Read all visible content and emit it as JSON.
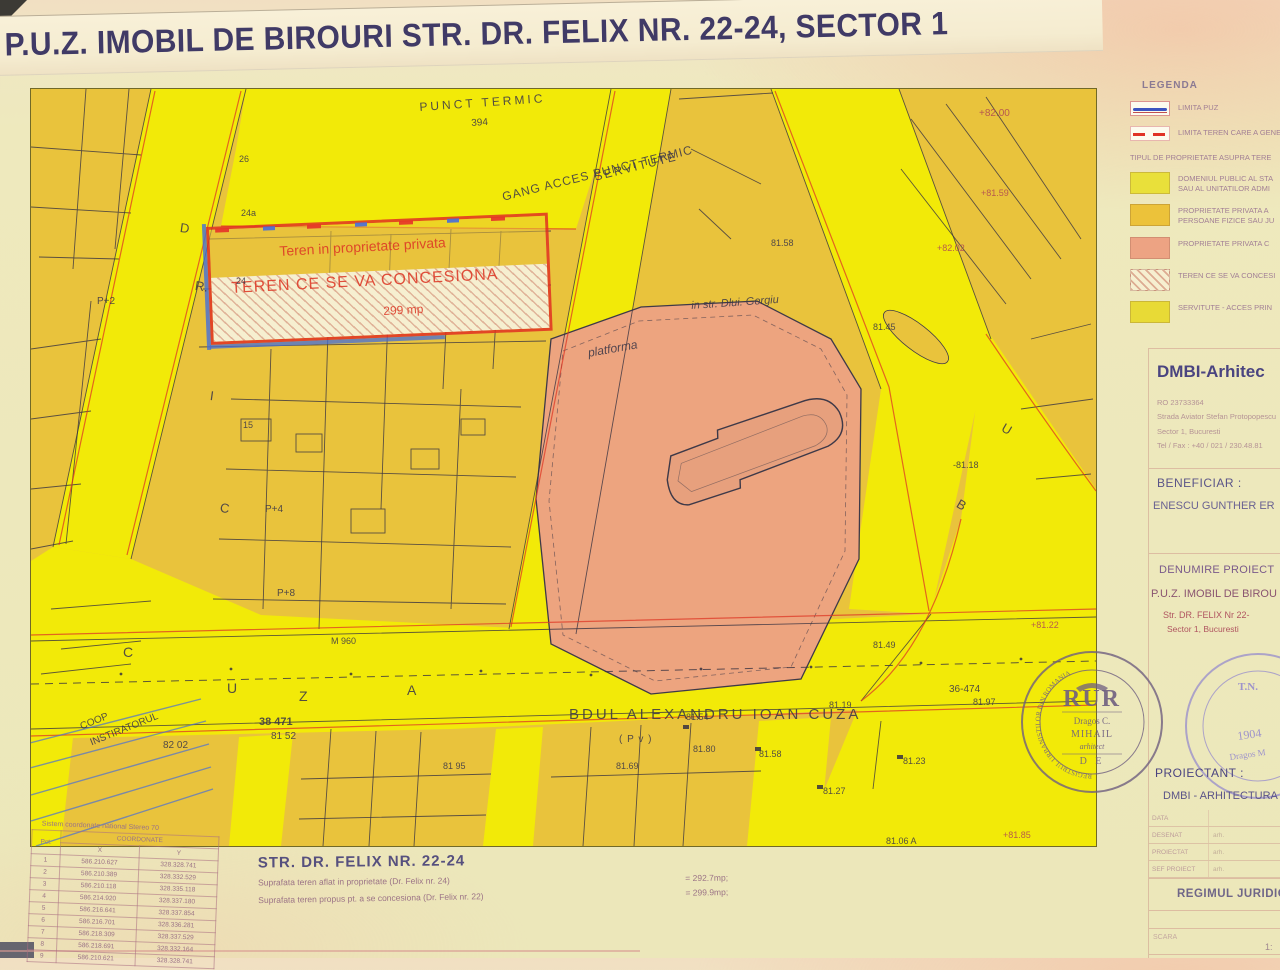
{
  "title": "P.U.Z. IMOBIL DE BIROURI STR. DR. FELIX NR. 22-24, SECTOR 1",
  "colors": {
    "road_yellow": "#f2ea08",
    "parcel_mustard": "#e9c33c",
    "private_salmon": "#eda47f",
    "line_red": "#dd3826",
    "line_blue": "#4a6fd4",
    "ink": "#3e3948"
  },
  "legend": {
    "heading": "LEGENDA",
    "line_items": [
      {
        "swatch": "line-blue",
        "label": "LIMITA PUZ"
      },
      {
        "swatch": "line-red",
        "label": "LIMITA TEREN CARE A GENER"
      }
    ],
    "section_heading": "TIPUL DE PROPRIETATE ASUPRA TERE",
    "items": [
      {
        "swatch": "yellow",
        "label": "DOMENIUL PUBLIC AL STA",
        "label2": "SAU AL UNITATILOR ADMI"
      },
      {
        "swatch": "orange",
        "label": "PROPRIETATE PRIVATA A",
        "label2": "PERSOANE FIZICE SAU JU"
      },
      {
        "swatch": "salmon",
        "label": "PROPRIETATE PRIVATA C",
        "label2": ""
      },
      {
        "swatch": "hatch",
        "label": "TEREN CE SE VA CONCESI",
        "label2": ""
      },
      {
        "swatch": "serv",
        "label": "SERVITUTE - ACCES PRIN",
        "label2": ""
      }
    ]
  },
  "panel": {
    "firm": "DMBI-Arhitec",
    "reg": "RO 23733364",
    "addr1": "Strada Aviator Stefan Protopopescu",
    "addr2": "Sector 1, Bucuresti",
    "tel": "Tel / Fax : +40 / 021 / 230.48.81",
    "beneficiar_label": "BENEFICIAR :",
    "beneficiar": "ENESCU GUNTHER ER",
    "denumire_label": "DENUMIRE PROIECT",
    "denumire1": "P.U.Z. IMOBIL DE BIROU",
    "denumire2": "Str. DR. FELIX Nr 22-",
    "denumire3": "Sector 1, Bucuresti",
    "proiectant_label": "PROIECTANT :",
    "proiectant": "DMBI - ARHITECTURA",
    "rows": [
      {
        "label": "DATA",
        "value": ""
      },
      {
        "label": "DESENAT",
        "value": "arh."
      },
      {
        "label": "PROIECTAT",
        "value": "arh."
      },
      {
        "label": "SEF PROIECT",
        "value": "arh."
      }
    ],
    "regim": "REGIMUL JURIDIC",
    "scara_label": "SCARA",
    "scara_value": "1:"
  },
  "stamps": {
    "rur": {
      "ring": "REGISTRUL URBANISTILOR DIN ROMANIA",
      "title": "RUR",
      "name1": "Dragos C.",
      "name2": "MIHAIL",
      "role": "arhitect",
      "de": "D E"
    },
    "oar": {
      "tn": "T.N.",
      "year": "1904",
      "name": "Dragos M"
    }
  },
  "coords_table": {
    "caption": "Sistem coordonate national Stereo 70",
    "col_pct": "Pct.",
    "col_group": "COORDONATE",
    "col_x": "X",
    "col_y": "Y",
    "rows": [
      {
        "pct": "1",
        "x": "586.210.627",
        "y": "328.328.741"
      },
      {
        "pct": "2",
        "x": "586.210.389",
        "y": "328.332.529"
      },
      {
        "pct": "3",
        "x": "586.210.118",
        "y": "328.335.118"
      },
      {
        "pct": "4",
        "x": "586.214.920",
        "y": "328.337.180"
      },
      {
        "pct": "5",
        "x": "586.216.641",
        "y": "328.337.854"
      },
      {
        "pct": "6",
        "x": "586.216.701",
        "y": "328.336.281"
      },
      {
        "pct": "7",
        "x": "586.218.309",
        "y": "328.337.529"
      },
      {
        "pct": "8",
        "x": "586.218.691",
        "y": "328.332.164"
      },
      {
        "pct": "9",
        "x": "586.210.621",
        "y": "328.328.741"
      }
    ]
  },
  "footer": {
    "street_title": "STR.  DR. FELIX NR. 22-24",
    "line1": "Suprafata teren aflat in proprietate (Dr. Felix nr. 24)",
    "line1_val": "= 292.7mp;",
    "line2": "Suprafata teren propus pt. a se concesiona (Dr. Felix nr. 22)",
    "line2_val": "= 299.9mp;"
  },
  "map": {
    "labels": [
      {
        "t": "PUNCT TERMIC",
        "x": 388,
        "y": 12,
        "s": 12,
        "c": "ink",
        "r": -4,
        "ls": 3
      },
      {
        "t": "394",
        "x": 440,
        "y": 30,
        "s": 10,
        "c": "ink",
        "r": -4
      },
      {
        "t": "SERVITUTE",
        "x": 562,
        "y": 82,
        "s": 12,
        "c": "ink",
        "r": -14,
        "ls": 2
      },
      {
        "t": "GANG ACCES PUNCT TERMIC",
        "x": 470,
        "y": 102,
        "s": 12,
        "c": "ink",
        "r": -14,
        "ls": 1
      },
      {
        "t": "Teren in proprietate privata",
        "x": 248,
        "y": 155,
        "s": 14,
        "c": "red",
        "r": -3
      },
      {
        "t": "TEREN CE SE VA CONCESIONA",
        "x": 200,
        "y": 192,
        "s": 16,
        "c": "red",
        "r": -3,
        "ls": 1
      },
      {
        "t": "299 mp",
        "x": 352,
        "y": 216,
        "s": 12,
        "c": "red",
        "r": -3
      },
      {
        "t": "platforma",
        "x": 556,
        "y": 258,
        "s": 12,
        "c": "ink",
        "r": -10,
        "i": 1
      },
      {
        "t": "in str. Dlui. Gergiu",
        "x": 660,
        "y": 212,
        "s": 11,
        "c": "ink",
        "r": -4,
        "i": 1
      },
      {
        "t": "BDUL ALEXANDRU IOAN CUZA",
        "x": 538,
        "y": 618,
        "s": 15,
        "c": "ink",
        "ls": 3
      },
      {
        "t": "( P v )",
        "x": 588,
        "y": 646,
        "s": 10,
        "c": "ink",
        "ls": 1
      },
      {
        "t": "38 471",
        "x": 228,
        "y": 628,
        "s": 11,
        "c": "ink",
        "b": 1
      },
      {
        "t": "81 52",
        "x": 240,
        "y": 643,
        "s": 10,
        "c": "ink"
      },
      {
        "t": "36-474",
        "x": 918,
        "y": 596,
        "s": 10,
        "c": "ink"
      },
      {
        "t": "81.97",
        "x": 942,
        "y": 609,
        "s": 9,
        "c": "ink"
      },
      {
        "t": "82 02",
        "x": 132,
        "y": 652,
        "s": 10,
        "c": "ink"
      },
      {
        "t": "COOP",
        "x": 48,
        "y": 634,
        "s": 10,
        "c": "ink",
        "r": -22
      },
      {
        "t": "INSTIRATORUL",
        "x": 58,
        "y": 650,
        "s": 10,
        "c": "ink",
        "r": -22
      },
      {
        "t": "M 960",
        "x": 300,
        "y": 548,
        "s": 9,
        "c": "ink"
      },
      {
        "t": "P+2",
        "x": 66,
        "y": 208,
        "s": 10,
        "c": "ink"
      },
      {
        "t": "P+4",
        "x": 234,
        "y": 416,
        "s": 10,
        "c": "ink"
      },
      {
        "t": "P+8",
        "x": 246,
        "y": 500,
        "s": 10,
        "c": "ink"
      },
      {
        "t": "26",
        "x": 208,
        "y": 66,
        "s": 9,
        "c": "ink"
      },
      {
        "t": "24a",
        "x": 210,
        "y": 120,
        "s": 9,
        "c": "ink"
      },
      {
        "t": "24",
        "x": 205,
        "y": 188,
        "s": 9,
        "c": "ink"
      },
      {
        "t": "15",
        "x": 212,
        "y": 332,
        "s": 9,
        "c": "ink"
      },
      {
        "t": "D",
        "x": 150,
        "y": 132,
        "s": 13,
        "c": "ink",
        "r": 8
      },
      {
        "t": "R.",
        "x": 165,
        "y": 190,
        "s": 13,
        "c": "ink",
        "r": 8
      },
      {
        "t": "I",
        "x": 180,
        "y": 300,
        "s": 13,
        "c": "ink",
        "r": 8
      },
      {
        "t": "C",
        "x": 190,
        "y": 412,
        "s": 13,
        "c": "ink",
        "r": 8
      },
      {
        "t": "C",
        "x": 92,
        "y": 556,
        "s": 14,
        "c": "ink"
      },
      {
        "t": "U",
        "x": 196,
        "y": 592,
        "s": 14,
        "c": "ink"
      },
      {
        "t": "Z",
        "x": 268,
        "y": 600,
        "s": 14,
        "c": "ink"
      },
      {
        "t": "A",
        "x": 376,
        "y": 594,
        "s": 14,
        "c": "ink"
      },
      {
        "t": "U",
        "x": 975,
        "y": 332,
        "s": 13,
        "c": "ink",
        "r": 30
      },
      {
        "t": "B",
        "x": 930,
        "y": 408,
        "s": 13,
        "c": "ink",
        "r": 30
      },
      {
        "t": "+82.00",
        "x": 948,
        "y": 20,
        "s": 10,
        "c": "redink"
      },
      {
        "t": "+81.59",
        "x": 950,
        "y": 100,
        "s": 9,
        "c": "redink"
      },
      {
        "t": "+82.02",
        "x": 906,
        "y": 155,
        "s": 9,
        "c": "redink"
      },
      {
        "t": "81.58",
        "x": 740,
        "y": 150,
        "s": 9,
        "c": "ink"
      },
      {
        "t": "81.45",
        "x": 842,
        "y": 234,
        "s": 9,
        "c": "ink"
      },
      {
        "t": "-81.18",
        "x": 922,
        "y": 372,
        "s": 9,
        "c": "ink"
      },
      {
        "t": "+81.22",
        "x": 1000,
        "y": 532,
        "s": 9,
        "c": "redink"
      },
      {
        "t": "81.49",
        "x": 842,
        "y": 552,
        "s": 9,
        "c": "ink"
      },
      {
        "t": "81.19",
        "x": 798,
        "y": 612,
        "s": 9,
        "c": "ink"
      },
      {
        "t": "81.54",
        "x": 655,
        "y": 624,
        "s": 9,
        "c": "ink"
      },
      {
        "t": "81.80",
        "x": 662,
        "y": 656,
        "s": 9,
        "c": "ink"
      },
      {
        "t": "81.58",
        "x": 728,
        "y": 661,
        "s": 9,
        "c": "ink"
      },
      {
        "t": "81.69",
        "x": 585,
        "y": 673,
        "s": 9,
        "c": "ink"
      },
      {
        "t": "81 95",
        "x": 412,
        "y": 673,
        "s": 9,
        "c": "ink"
      },
      {
        "t": "81.23",
        "x": 872,
        "y": 668,
        "s": 9,
        "c": "ink"
      },
      {
        "t": "81.27",
        "x": 792,
        "y": 698,
        "s": 9,
        "c": "ink"
      },
      {
        "t": "81.06 A",
        "x": 855,
        "y": 748,
        "s": 9,
        "c": "ink"
      },
      {
        "t": "+81.85",
        "x": 972,
        "y": 742,
        "s": 9,
        "c": "redink"
      }
    ]
  }
}
